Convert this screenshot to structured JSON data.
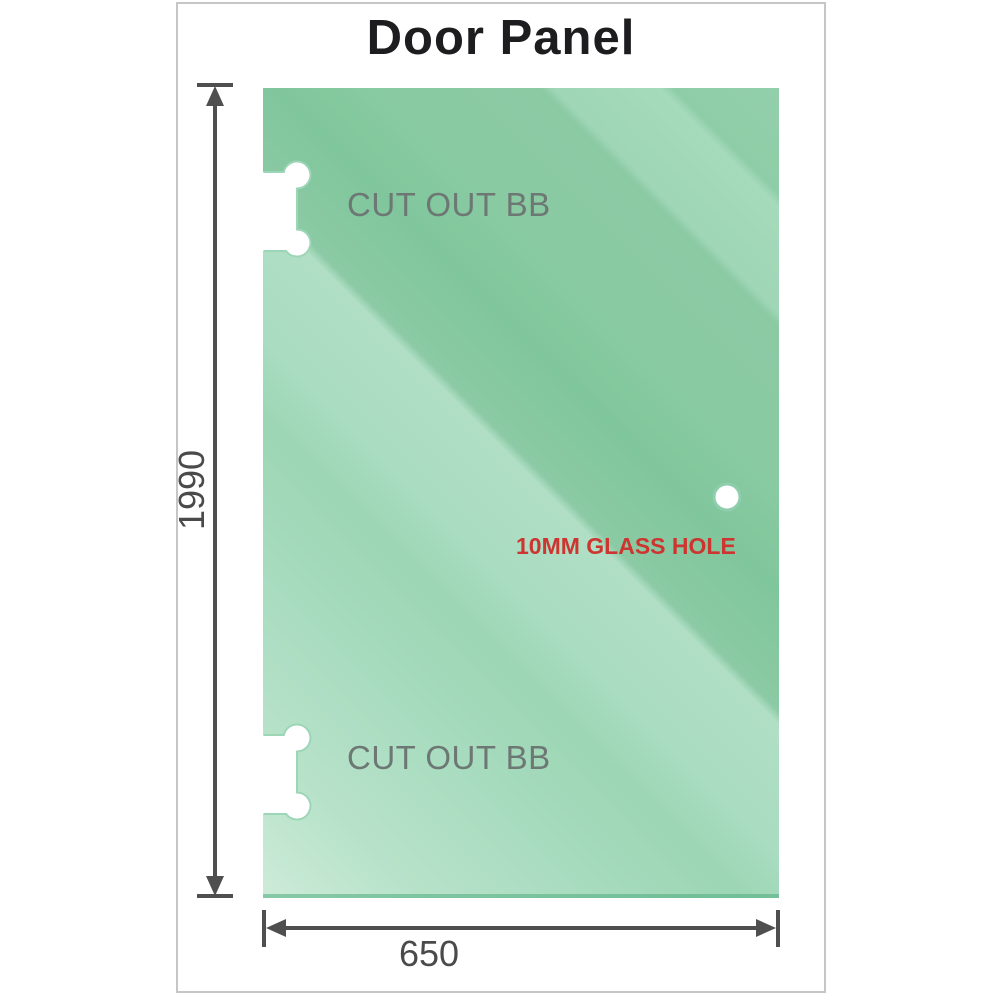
{
  "title": "Door Panel",
  "panel": {
    "cutouts": [
      {
        "label": "CUT OUT BB"
      },
      {
        "label": "CUT OUT BB"
      }
    ],
    "hole": {
      "label": "10MM GLASS HOLE"
    }
  },
  "dimensions": {
    "height": {
      "value": "1990"
    },
    "width": {
      "value": "650"
    }
  },
  "colors": {
    "frame-border": "#c6c6c6",
    "title-color": "#1d1d20",
    "panel-base": "#92cfaa",
    "panel-light": "#cdebd8",
    "panel-dark": "#80c69c",
    "panel-edge": "#4fad7d",
    "cutout-outline": "#9dd5b7",
    "hole-ring": "#8fceac",
    "cutout-label-color": "#6d7874",
    "hole-label-color": "#cd3531",
    "dim-line-color": "#4f4f4f",
    "dim-label-color": "#4a4a4a"
  }
}
